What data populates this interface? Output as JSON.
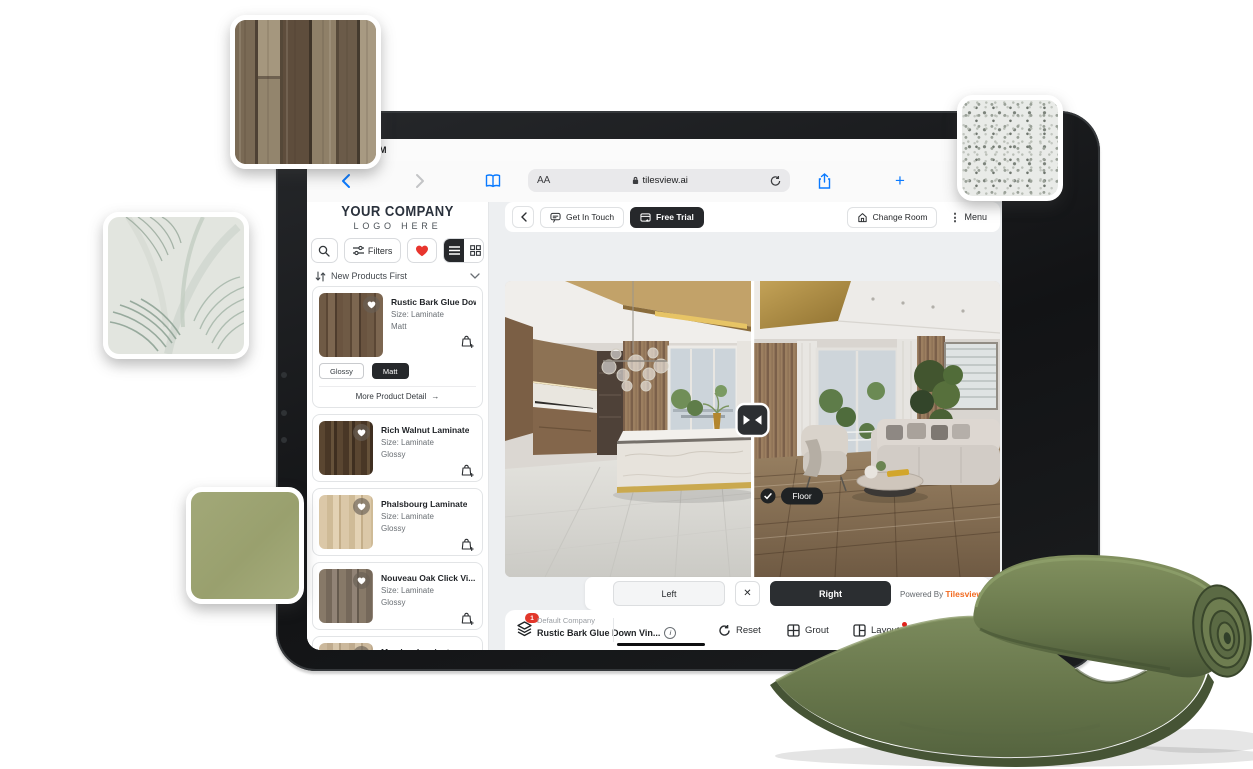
{
  "status_bar": {
    "time": "PM"
  },
  "browser": {
    "reader_label": "AA",
    "url": "tilesview.ai"
  },
  "header": {
    "get_in_touch": "Get In Touch",
    "free_trial": "Free Trial",
    "change_room": "Change Room",
    "menu": "Menu"
  },
  "sidebar": {
    "logo_line1": "YOUR COMPANY",
    "logo_line2": "LOGO HERE",
    "filters_label": "Filters",
    "sort_label": "New Products First",
    "products": [
      {
        "name": "Rustic Bark Glue Dow...",
        "size": "Size: Laminate",
        "finish": "Matt",
        "finish_options": [
          "Glossy",
          "Matt"
        ],
        "selected_finish": "Matt",
        "more_label": "More Product Detail"
      },
      {
        "name": "Rich Walnut Laminate",
        "size": "Size: Laminate",
        "finish": "Glossy"
      },
      {
        "name": "Phalsbourg Laminate",
        "size": "Size: Laminate",
        "finish": "Glossy"
      },
      {
        "name": "Nouveau Oak Click Vi...",
        "size": "Size: Laminate",
        "finish": "Glossy"
      },
      {
        "name": "Meadow Laminate",
        "size": "Size: Laminate"
      }
    ]
  },
  "viewer": {
    "floor_tag": "Floor",
    "left_label": "Left",
    "right_label": "Right",
    "powered_by": "Powered By ",
    "brand": "Tilesview"
  },
  "bottom_bar": {
    "badge": "1",
    "company": "Default Company",
    "product": "Rustic Bark Glue Down Vin...",
    "reset": "Reset",
    "grout": "Grout",
    "layout": "Layout",
    "compare": "Compare"
  },
  "glyphs": {
    "close": "✕",
    "arrow_right": "→",
    "menu_dots": "⋮",
    "plus": "+",
    "info": "i"
  },
  "colors": {
    "accent_orange": "#f26a20",
    "heart_red": "#e8352e",
    "dark": "#26282b",
    "ios_blue": "#0a7aff",
    "badge_red": "#e2372b"
  }
}
